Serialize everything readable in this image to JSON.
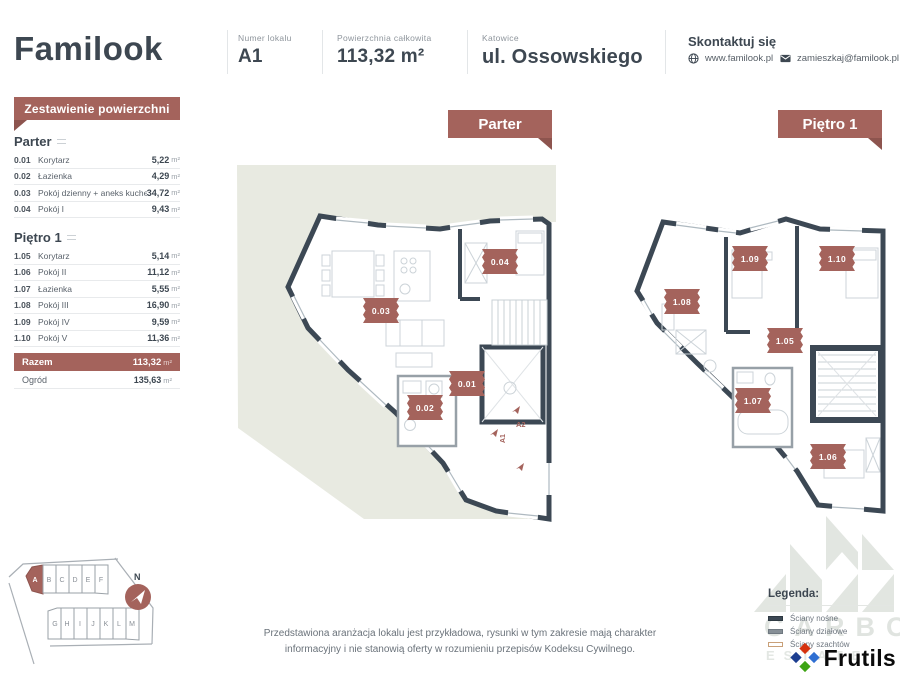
{
  "header": {
    "logo": "Familook",
    "unit_number_label": "Numer lokalu",
    "unit_number": "A1",
    "area_label": "Powierzchnia całkowita",
    "area_value": "113,32 m²",
    "city": "Katowice",
    "street": "ul. Ossowskiego",
    "contact_title": "Skontaktuj się",
    "website": "www.familook.pl",
    "email": "zamieszkaj@familook.pl"
  },
  "area_table": {
    "title": "Zestawienie powierzchni",
    "unit": "m²",
    "sections": [
      {
        "name": "Parter",
        "rows": [
          {
            "no": "0.01",
            "room": "Korytarz",
            "area": "5,22"
          },
          {
            "no": "0.02",
            "room": "Łazienka",
            "area": "4,29"
          },
          {
            "no": "0.03",
            "room": "Pokój dzienny + aneks kuchenny",
            "area": "34,72"
          },
          {
            "no": "0.04",
            "room": "Pokój I",
            "area": "9,43"
          }
        ]
      },
      {
        "name": "Piętro 1",
        "rows": [
          {
            "no": "1.05",
            "room": "Korytarz",
            "area": "5,14"
          },
          {
            "no": "1.06",
            "room": "Pokój II",
            "area": "11,12"
          },
          {
            "no": "1.07",
            "room": "Łazienka",
            "area": "5,55"
          },
          {
            "no": "1.08",
            "room": "Pokój III",
            "area": "16,90"
          },
          {
            "no": "1.09",
            "room": "Pokój IV",
            "area": "9,59"
          },
          {
            "no": "1.10",
            "room": "Pokój V",
            "area": "11,36"
          }
        ]
      }
    ],
    "total_label": "Razem",
    "total_area": "113,32",
    "garden_label": "Ogród",
    "garden_area": "135,63"
  },
  "plans": [
    {
      "banner": "Parter",
      "labels": [
        "0.01",
        "0.02",
        "0.03",
        "0.04"
      ],
      "annotations": [
        "A1",
        "A2"
      ]
    },
    {
      "banner": "Piętro 1",
      "labels": [
        "1.05",
        "1.06",
        "1.07",
        "1.08",
        "1.09",
        "1.10"
      ]
    }
  ],
  "site_map": {
    "compass": "N",
    "highlighted": "A",
    "row1": [
      "A",
      "B",
      "C",
      "D",
      "E",
      "F"
    ],
    "row2": [
      "G",
      "H",
      "I",
      "J",
      "K",
      "L",
      "M"
    ]
  },
  "disclaimer": {
    "line1": "Przedstawiona aranżacja lokalu jest przykładowa, rysunki w tym zakresie mają charakter",
    "line2": "informacyjny i nie stanowią oferty w rozumieniu przepisów Kodeksu Cywilnego."
  },
  "legend": {
    "title": "Legenda:",
    "items": [
      {
        "label": "Ściany nośne"
      },
      {
        "label": "Ściany działowe"
      },
      {
        "label": "Ściany szachtów"
      }
    ]
  },
  "watermark": {
    "line1": "CARBON",
    "line2": "ESTATE"
  },
  "footer_logo": {
    "text": "Frutils"
  },
  "icons": {
    "website": "globe-icon",
    "email": "mail-icon",
    "compass": "north-arrow-icon"
  },
  "colors": {
    "accent_maroon": "#a4635c",
    "dark_slate": "#3d4751",
    "wall": "#3c4854",
    "garden": "#e8eae1",
    "frutils_red": "#d5310e",
    "frutils_navy": "#1c3e90",
    "frutils_blue": "#2f6fd2",
    "frutils_green": "#3da414"
  }
}
